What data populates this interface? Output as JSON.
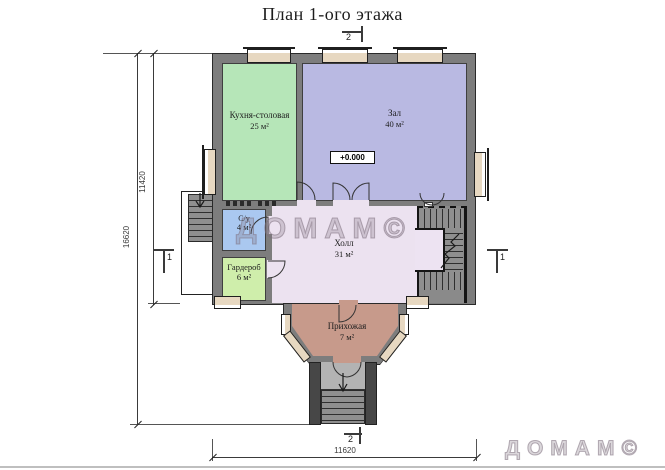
{
  "title": "План 1-ого этажа",
  "watermark": {
    "center": "ДОМАМ©",
    "corner": "ДОМАМ©"
  },
  "rooms": {
    "kitchen": {
      "name": "Кухня-столовая",
      "area": "25 м²",
      "color": "#b6e6b8"
    },
    "zal": {
      "name": "Зал",
      "area": "40 м²",
      "color": "#b9b9e2"
    },
    "su": {
      "name": "С/у",
      "area": "4 м²",
      "color": "#aac8f0"
    },
    "garderob": {
      "name": "Гардероб",
      "area": "6 м²",
      "color": "#cfeeab"
    },
    "holl": {
      "name": "Холл",
      "area": "31 м²",
      "color": "#ece2f0"
    },
    "prihozhaya": {
      "name": "Прихожая",
      "area": "7 м²",
      "color": "#c79a8b"
    }
  },
  "elevation": {
    "value": "+0.000"
  },
  "dimensions": {
    "left_outer": "16620",
    "left_inner": "11420",
    "bottom": "11620"
  },
  "section_marks": {
    "top": "2",
    "bottom": "2",
    "left": "1",
    "right": "1"
  },
  "colors": {
    "wall": "#7d7d7d",
    "wall_dark": "#2a2a2a",
    "window": "#e7d8c1",
    "stairs": "#8f8f8f",
    "watermark_outline": "#7d707d"
  }
}
